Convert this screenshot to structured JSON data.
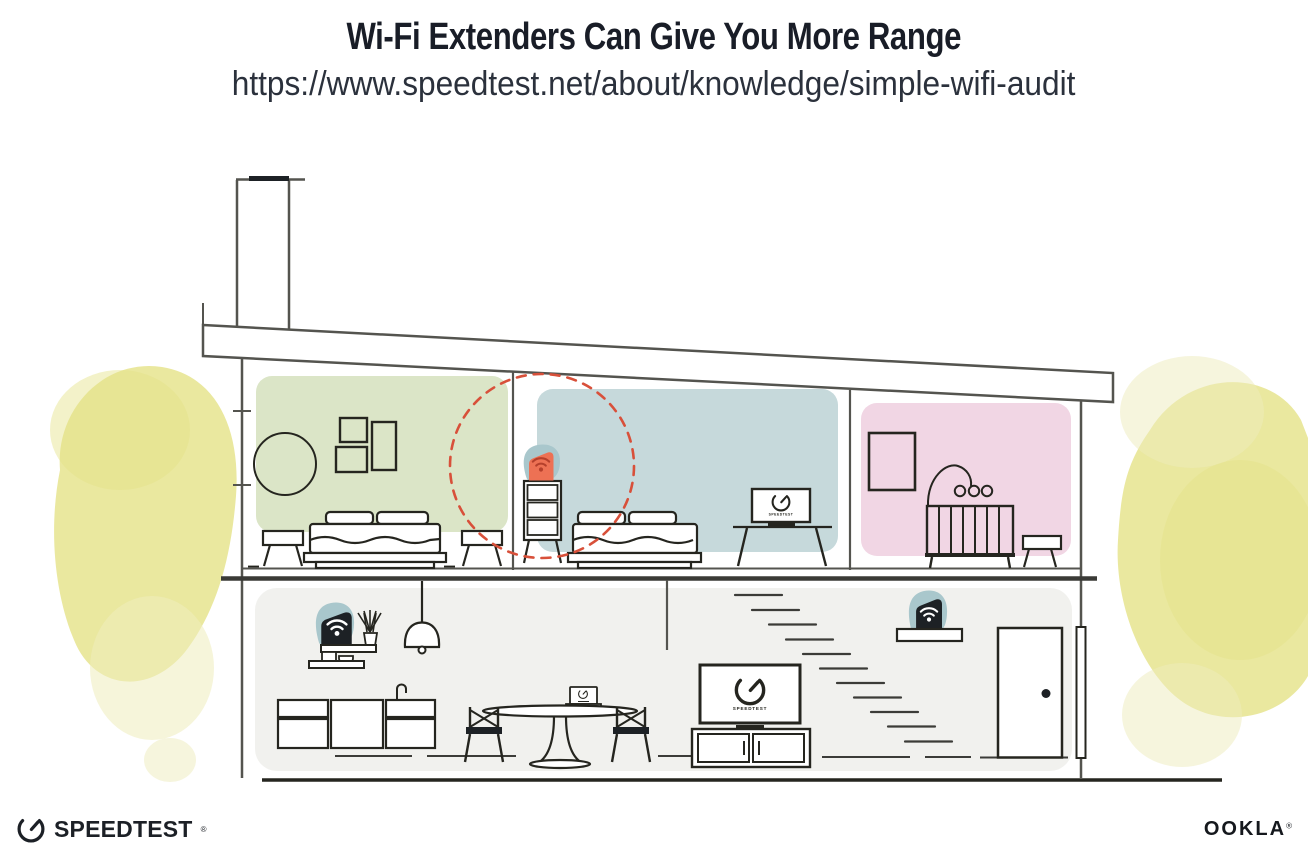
{
  "header": {
    "title": "Wi-Fi Extenders Can Give You More Range",
    "url": "https://www.speedtest.net/about/knowledge/simple-wifi-audit"
  },
  "illustration": {
    "tv_label": "SPEEDTEST",
    "icons": {
      "extender": "wifi-extender-shield-icon",
      "wifi": "wifi-icon",
      "gauge": "speedtest-gauge-icon",
      "range": "extender-range-dashed-circle"
    },
    "colors": {
      "room_green": "#dbe5c7",
      "room_blue": "#c6d9db",
      "room_pink": "#f1d6e4",
      "lower_floor": "#f1f1ee",
      "foliage": "#e5e287",
      "foliage_light": "#eeecbc",
      "extender_teal": "#a9c7cc",
      "extender_orange": "#ed7154",
      "extender_orange_dark": "#b5402c",
      "device_black": "#1d2125",
      "device_glyph_white": "#ffffff",
      "range_dash_red": "#d8503a",
      "structure_gray": "#54544f",
      "ink": "#25251f"
    }
  },
  "footer": {
    "speedtest_wordmark": "SPEEDTEST",
    "speedtest_reg": "®",
    "ookla_wordmark": "OOKLA",
    "ookla_reg": "®"
  }
}
